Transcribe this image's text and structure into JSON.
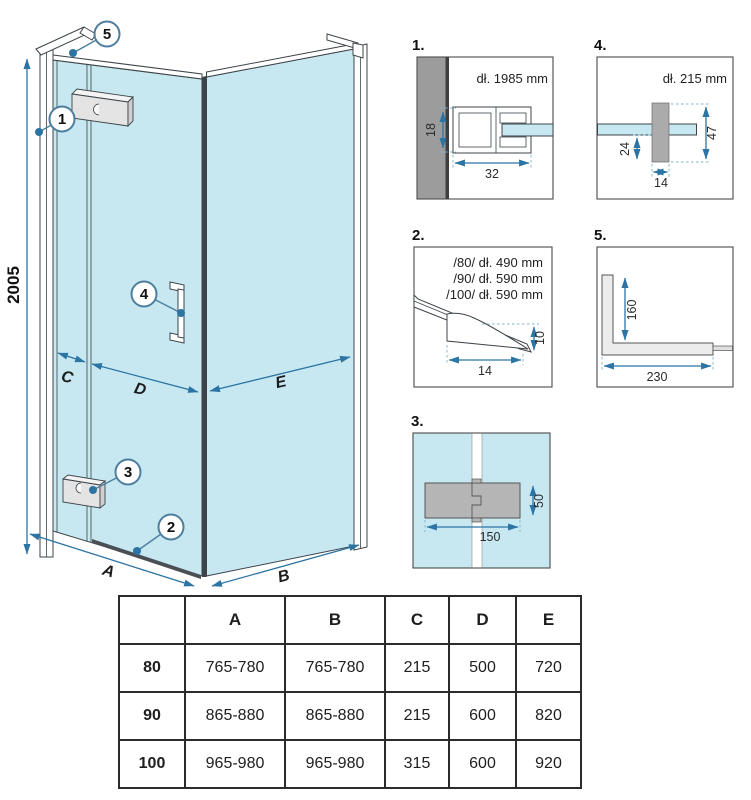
{
  "main": {
    "height_dim": "2005",
    "dims": {
      "A": "A",
      "B": "B",
      "C": "C",
      "D": "D",
      "E": "E"
    },
    "callouts": {
      "c1": "1",
      "c2": "2",
      "c3": "3",
      "c4": "4",
      "c5": "5"
    }
  },
  "details": {
    "d1": {
      "label": "1.",
      "title": "dł. 1985 mm",
      "dim_height": "18",
      "dim_width": "32"
    },
    "d2": {
      "label": "2.",
      "size_lines": [
        "/80/ dł. 490 mm",
        "/90/ dł. 590 mm",
        "/100/ dł. 590 mm"
      ],
      "dim_width": "14",
      "dim_height": "10"
    },
    "d3": {
      "label": "3.",
      "dim_width": "150",
      "dim_height": "50"
    },
    "d4": {
      "label": "4.",
      "title": "dł. 215 mm",
      "dim_offset": "24",
      "dim_total": "47",
      "dim_width": "14"
    },
    "d5": {
      "label": "5.",
      "dim_vertical": "160",
      "dim_horizontal": "230"
    }
  },
  "table": {
    "headers": [
      "",
      "A",
      "B",
      "C",
      "D",
      "E"
    ],
    "rows": [
      {
        "size": "80",
        "values": [
          "765-780",
          "765-780",
          "215",
          "500",
          "720"
        ]
      },
      {
        "size": "90",
        "values": [
          "865-880",
          "865-880",
          "215",
          "600",
          "820"
        ]
      },
      {
        "size": "100",
        "values": [
          "965-980",
          "965-980",
          "315",
          "600",
          "920"
        ]
      }
    ]
  },
  "colors": {
    "glass": "#c7e8f1",
    "dimension_blue": "#2b74a3",
    "wall_gray": "#9c9c9c",
    "hinge_gray": "#b5b5b5",
    "line_dark": "#3d4449"
  }
}
